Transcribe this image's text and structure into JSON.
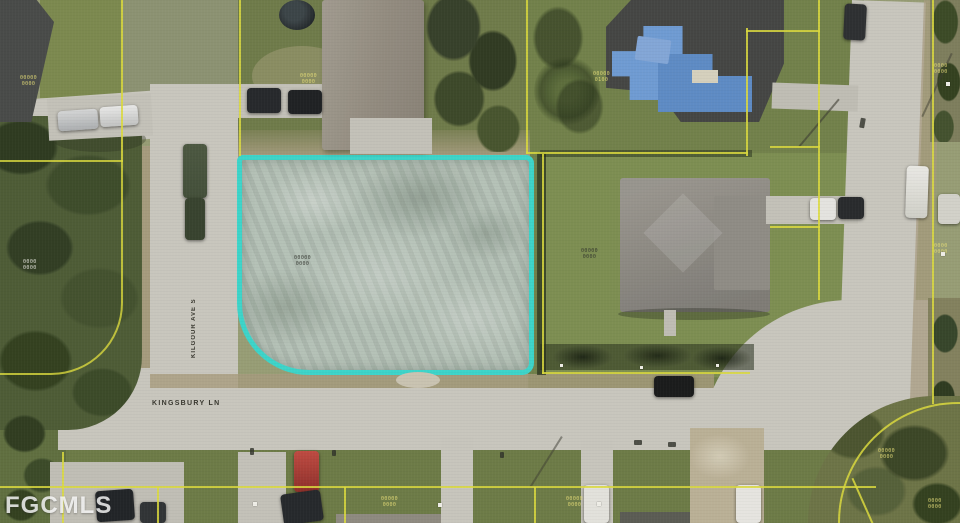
{
  "canvas": {
    "width": 960,
    "height": 523,
    "description": "Aerial MLS real-estate photo: vacant cleared residential lot outlined in cyan at a street corner, neighboring houses around it"
  },
  "watermark": {
    "text": "FGCMLS"
  },
  "street_labels": {
    "bottom_street": "KINGSBURY LN",
    "left_street_vertical": "KILGOUR AVE S"
  },
  "property": {
    "outline_color": "#3bd9cf",
    "outline_shape": "rectangle with large rounded south-west corner",
    "lot_condition": "cleared pale dirt / scraped ground"
  },
  "colors": {
    "lot_outline": "#3bd9cf",
    "parcel_line": "#dfdf3e",
    "road": "#cbcac2",
    "shoulder": "#a99d80",
    "lawn": "#6f7c4a",
    "lawn_bright": "#7d9053",
    "lawn_dull": "#8d9474",
    "trees": "#44542f",
    "lot_fill": "#b4c2b8",
    "roof_gray": "#928e86",
    "roof_dark": "#434544",
    "tarp_blue": "#6f9ed8",
    "label_yellow": "#e9e27a",
    "label_dark": "#2b2f29",
    "label_white": "#f2f2ec"
  },
  "parcel_labels": [
    {
      "x": 20,
      "y": 76,
      "color": "yellow",
      "line1": "00000",
      "line2": "0000"
    },
    {
      "x": 300,
      "y": 74,
      "color": "yellow",
      "line1": "00000",
      "line2": "0000"
    },
    {
      "x": 593,
      "y": 72,
      "color": "yellow",
      "line1": "00000",
      "line2": "0100"
    },
    {
      "x": 294,
      "y": 256,
      "color": "dark",
      "line1": "00000",
      "line2": "0000"
    },
    {
      "x": 581,
      "y": 249,
      "color": "dark",
      "line1": "00000",
      "line2": "0000"
    },
    {
      "x": 934,
      "y": 64,
      "color": "yellow",
      "line1": "0000",
      "line2": "0000"
    },
    {
      "x": 934,
      "y": 244,
      "color": "yellow",
      "line1": "0000",
      "line2": "0000"
    },
    {
      "x": 23,
      "y": 260,
      "color": "white",
      "line1": "0000",
      "line2": "0000"
    },
    {
      "x": 381,
      "y": 497,
      "color": "yellow",
      "line1": "00000",
      "line2": "0000"
    },
    {
      "x": 566,
      "y": 497,
      "color": "yellow",
      "line1": "00000",
      "line2": "0000"
    },
    {
      "x": 878,
      "y": 449,
      "color": "yellow",
      "line1": "00000",
      "line2": "0000"
    },
    {
      "x": 928,
      "y": 499,
      "color": "yellow",
      "line1": "0000",
      "line2": "0000"
    }
  ],
  "corner_markers": [
    {
      "x": 253,
      "y": 502
    },
    {
      "x": 438,
      "y": 503
    },
    {
      "x": 597,
      "y": 502
    },
    {
      "x": 946,
      "y": 82
    },
    {
      "x": 941,
      "y": 252
    }
  ]
}
